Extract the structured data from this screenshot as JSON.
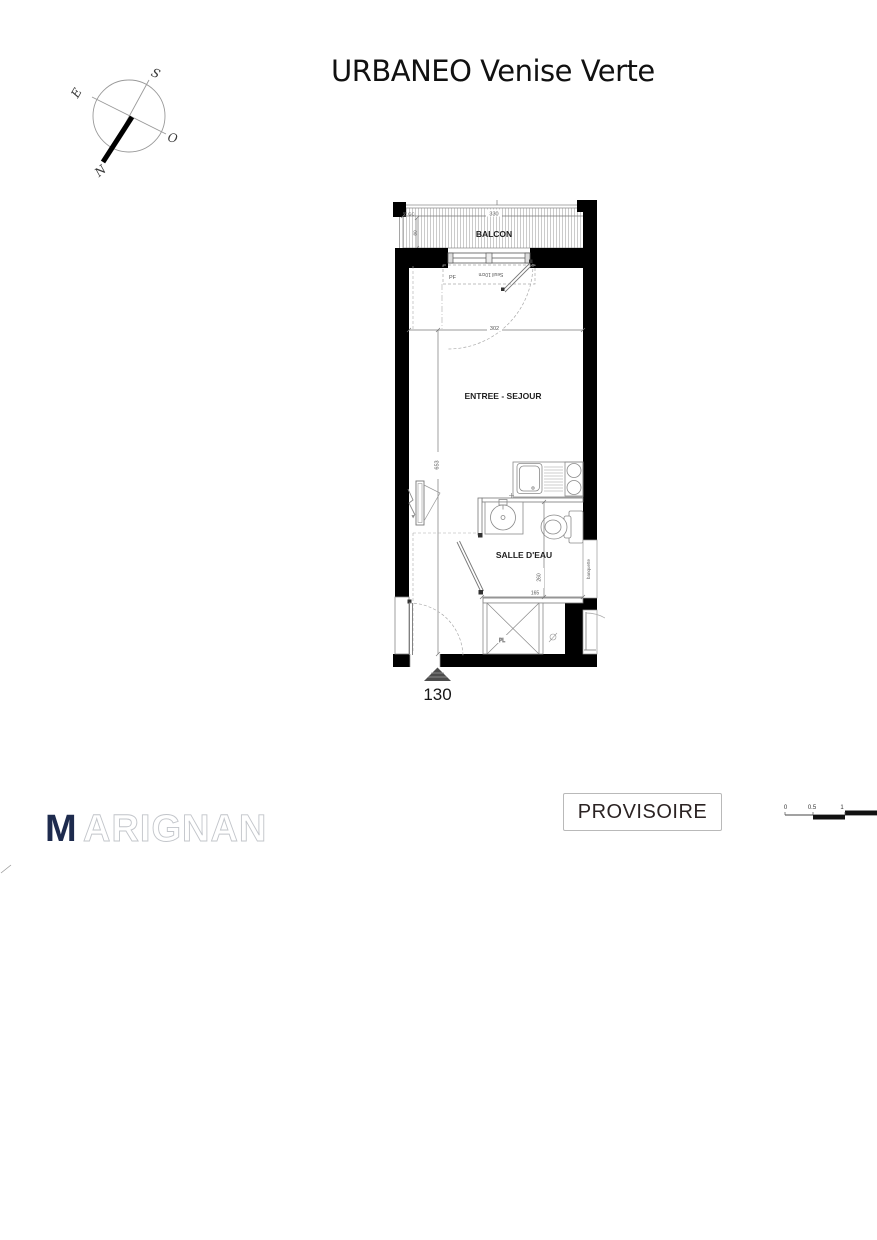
{
  "title": "URBANEO Venise Verte",
  "compass": {
    "north": "N",
    "south": "S",
    "east": "E",
    "west": "O"
  },
  "plan": {
    "balcony": {
      "label": "BALCON",
      "width_dim": "330",
      "depth_dim": "80",
      "gutter_label": "GC"
    },
    "window": {
      "label": "PF",
      "threshold_label": "Seuil 10cm"
    },
    "living": {
      "label": "ENTREE - SEJOUR",
      "width_dim": "302",
      "length_dim": "653"
    },
    "bathroom": {
      "label": "SALLE D'EAU",
      "depth_dim": "260",
      "width_dim": "165",
      "bench_label": "banquette"
    },
    "closet_label": "PL",
    "unit_number": "130"
  },
  "stamp_label": "PROVISOIRE",
  "logo": {
    "initial": "M",
    "rest": "ARIGNAN",
    "brand_color": "#1e2b4e"
  },
  "scale_bar": {
    "tick0": "0",
    "tick05": "0.5",
    "tick1": "1"
  },
  "colors": {
    "wall": "#000000",
    "stamp_border": "#b9b9b9"
  }
}
